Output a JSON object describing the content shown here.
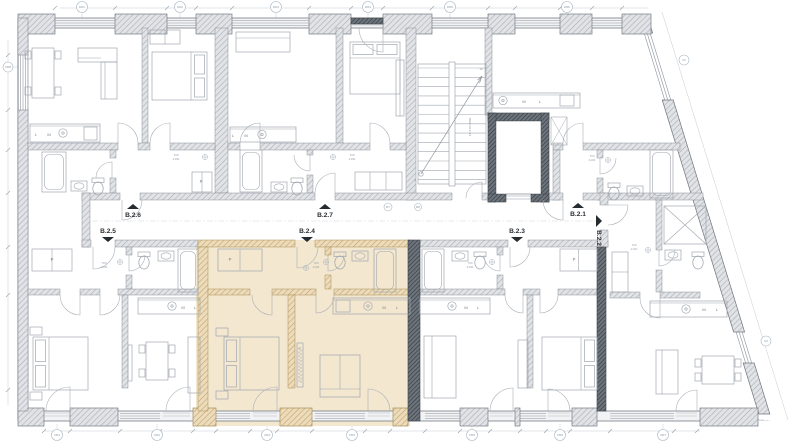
{
  "plan_title": "floor-plan",
  "apartments": {
    "b21": "B.2.1",
    "b22": "B.2.2",
    "b23": "B.2.3",
    "b24": "B.2.4",
    "b25": "B.2.5",
    "b26": "B.2.6",
    "b27": "B.2.7"
  },
  "highlighted_unit": "B.2.4",
  "letters": {
    "m": "M",
    "l": "L",
    "closet": "P"
  },
  "stairs": {
    "note": "16×175=2800",
    "top": "10",
    "bottom": "1"
  },
  "door_note": {
    "w": "700",
    "h": "2100"
  },
  "tags": {
    "top": [
      "D01",
      "D02",
      "D03",
      "D04",
      "D05",
      "D06"
    ],
    "bottom": [
      "O01",
      "O02",
      "O03",
      "O04",
      "O05",
      "O06",
      "O07"
    ],
    "left": "O08",
    "diag": [
      "V1",
      "V2"
    ],
    "corridor": [
      "R7",
      "R8"
    ]
  },
  "colors": {
    "highlight": "#f3e7cf",
    "wall_gray": "#e2e4e7",
    "wall_dark": "#4e545b",
    "wall_tan": "#ead9b7",
    "line": "#9aa1a9",
    "label": "#2c3136"
  }
}
